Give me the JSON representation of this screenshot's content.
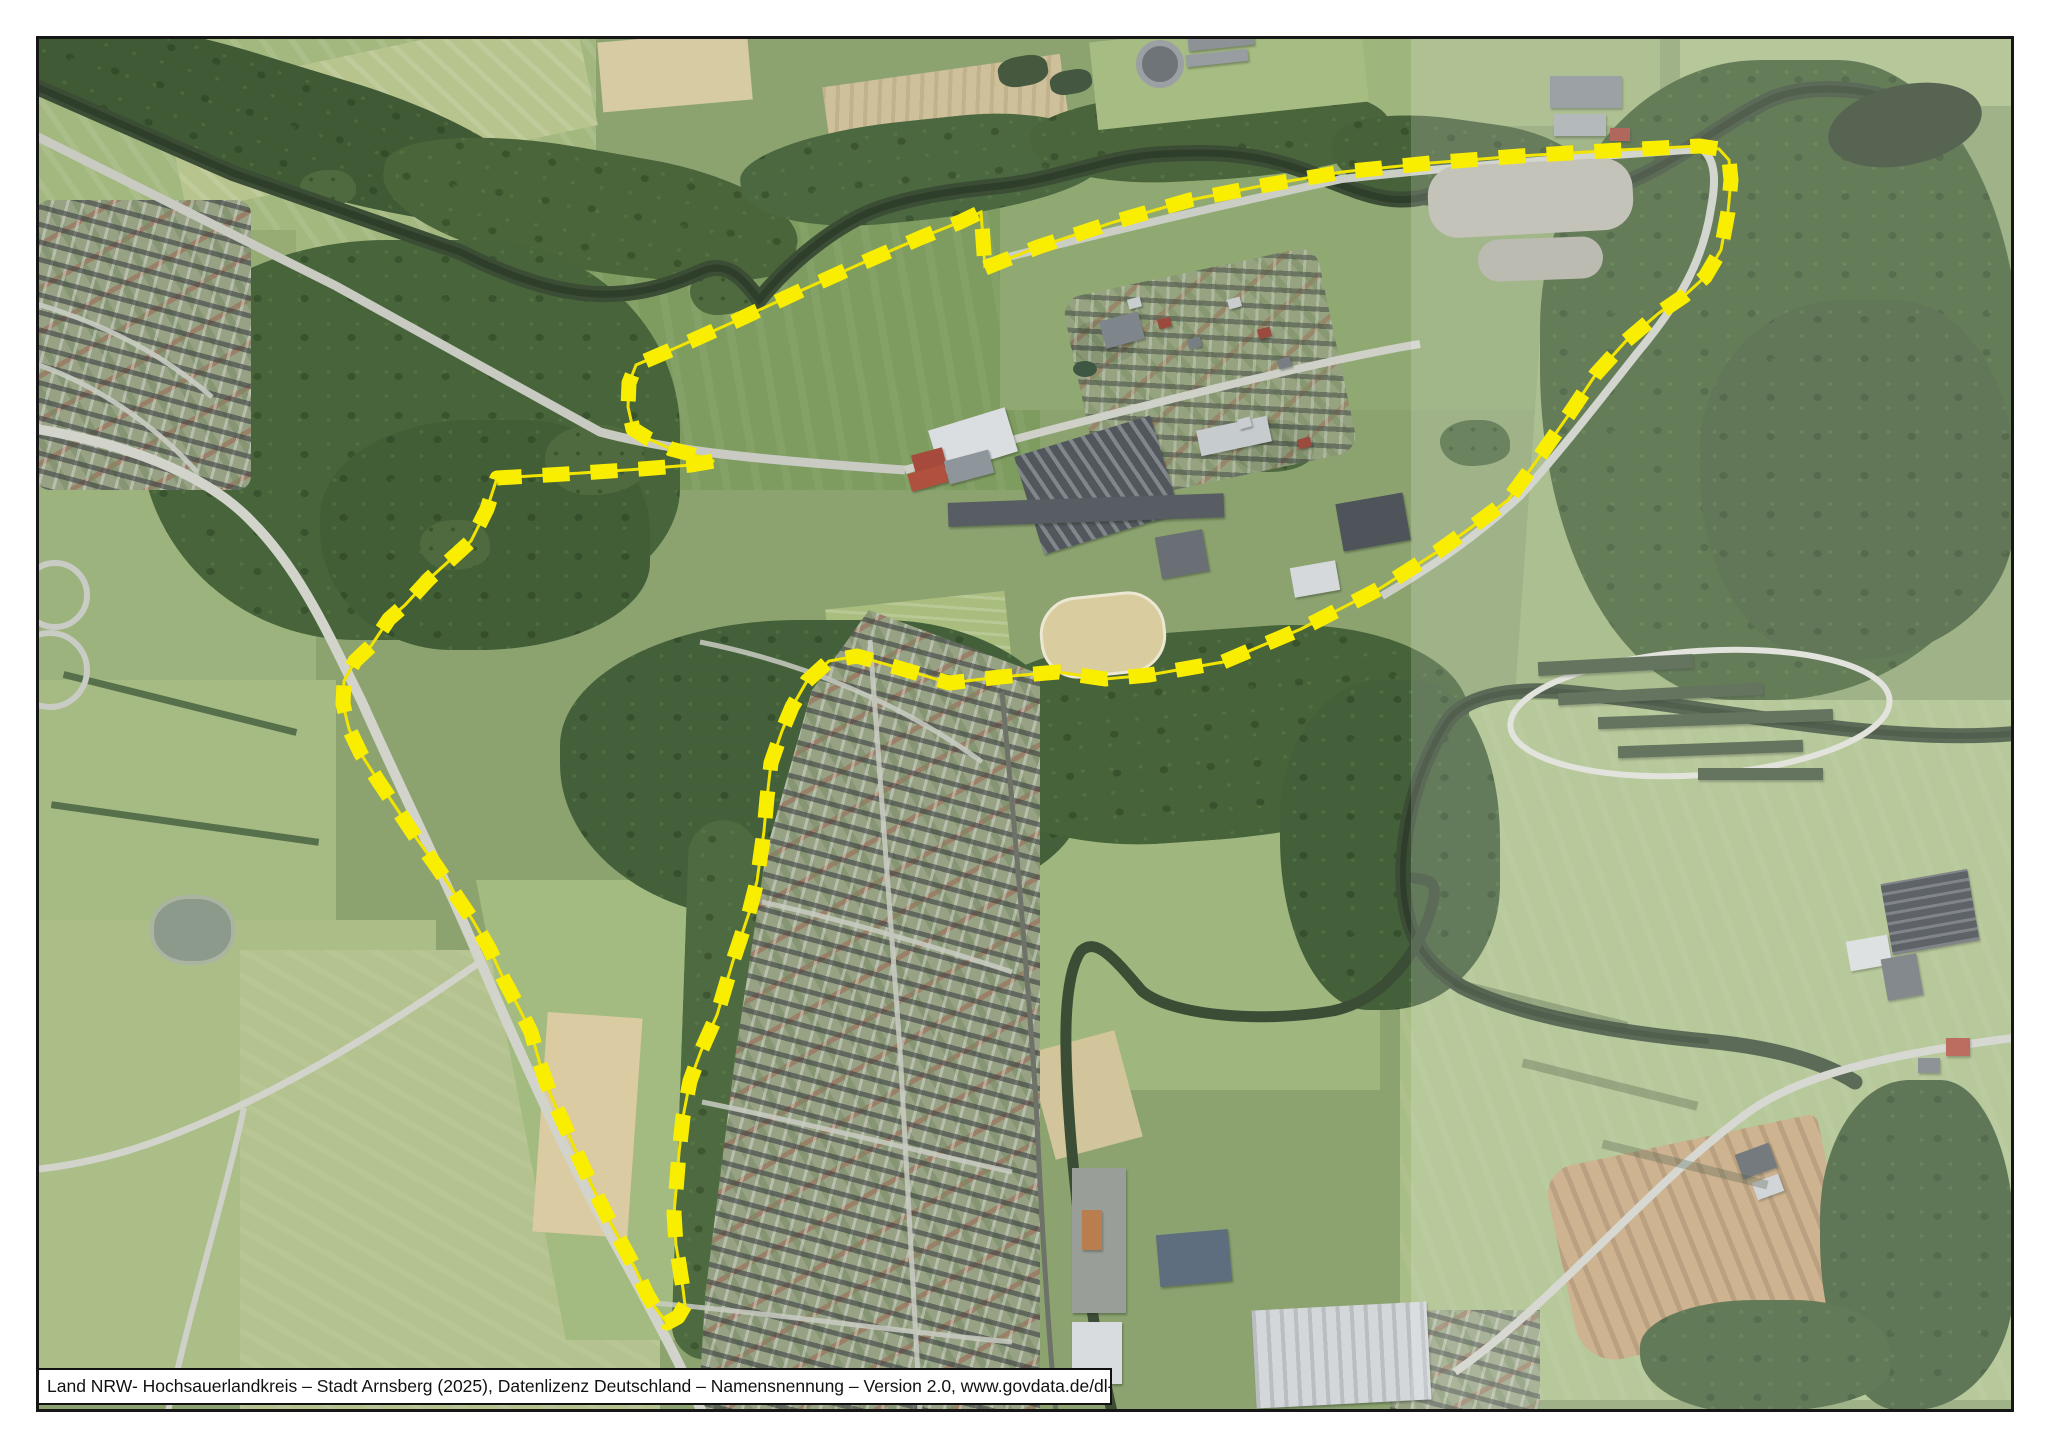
{
  "map": {
    "type": "aerial-orthophoto-sheet",
    "attribution": "Land NRW- Hochsauerlandkreis – Stadt Arnsberg (2025), Datenlizenz Deutschland – Namensnennung – Version 2.0, www.govdata.de/dl-de/by-2-0",
    "frame_color": "#161616",
    "overlay": {
      "exposure_seam_x": 1411,
      "haze_opacity": 0.17
    },
    "boundary": {
      "label": "site-boundary-outline",
      "color": "#FAEE00",
      "underline_color": "#F0E400",
      "stroke_width": 15,
      "dash": [
        27,
        21
      ],
      "points": [
        [
          985,
          268
        ],
        [
          1038,
          247
        ],
        [
          1114,
          222
        ],
        [
          1190,
          200
        ],
        [
          1266,
          185
        ],
        [
          1342,
          172
        ],
        [
          1430,
          163
        ],
        [
          1520,
          156
        ],
        [
          1620,
          150
        ],
        [
          1700,
          146
        ],
        [
          1719,
          149
        ],
        [
          1729,
          160
        ],
        [
          1731,
          180
        ],
        [
          1728,
          212
        ],
        [
          1721,
          250
        ],
        [
          1705,
          277
        ],
        [
          1684,
          296
        ],
        [
          1659,
          313
        ],
        [
          1626,
          341
        ],
        [
          1596,
          374
        ],
        [
          1572,
          410
        ],
        [
          1556,
          433
        ],
        [
          1535,
          463
        ],
        [
          1508,
          500
        ],
        [
          1469,
          529
        ],
        [
          1437,
          552
        ],
        [
          1379,
          589
        ],
        [
          1301,
          629
        ],
        [
          1223,
          662
        ],
        [
          1149,
          675
        ],
        [
          1105,
          679
        ],
        [
          1058,
          672
        ],
        [
          1000,
          677
        ],
        [
          949,
          683
        ],
        [
          899,
          668
        ],
        [
          857,
          656
        ],
        [
          829,
          661
        ],
        [
          807,
          681
        ],
        [
          792,
          707
        ],
        [
          782,
          731
        ],
        [
          771,
          763
        ],
        [
          767,
          798
        ],
        [
          764,
          831
        ],
        [
          757,
          881
        ],
        [
          749,
          913
        ],
        [
          733,
          961
        ],
        [
          717,
          1015
        ],
        [
          701,
          1051
        ],
        [
          690,
          1081
        ],
        [
          683,
          1117
        ],
        [
          679,
          1153
        ],
        [
          676,
          1191
        ],
        [
          674,
          1213
        ],
        [
          676,
          1245
        ],
        [
          679,
          1263
        ],
        [
          683,
          1289
        ],
        [
          685,
          1305
        ],
        [
          678,
          1317
        ],
        [
          667,
          1323
        ],
        [
          654,
          1306
        ],
        [
          647,
          1294
        ],
        [
          636,
          1270
        ],
        [
          621,
          1242
        ],
        [
          609,
          1220
        ],
        [
          595,
          1192
        ],
        [
          579,
          1158
        ],
        [
          564,
          1124
        ],
        [
          551,
          1096
        ],
        [
          540,
          1064
        ],
        [
          531,
          1032
        ],
        [
          519,
          1008
        ],
        [
          504,
          980
        ],
        [
          489,
          948
        ],
        [
          472,
          919
        ],
        [
          457,
          897
        ],
        [
          437,
          867
        ],
        [
          417,
          839
        ],
        [
          397,
          809
        ],
        [
          377,
          779
        ],
        [
          361,
          754
        ],
        [
          349,
          729
        ],
        [
          343,
          704
        ],
        [
          344,
          681
        ],
        [
          355,
          661
        ],
        [
          371,
          646
        ],
        [
          389,
          619
        ],
        [
          405,
          605
        ],
        [
          429,
          579
        ],
        [
          449,
          561
        ],
        [
          471,
          541
        ],
        [
          487,
          509
        ],
        [
          497,
          478
        ],
        [
          531,
          476
        ],
        [
          581,
          473
        ],
        [
          641,
          469
        ],
        [
          691,
          465
        ],
        [
          714,
          461
        ],
        [
          698,
          456
        ],
        [
          671,
          449
        ],
        [
          649,
          439
        ],
        [
          633,
          429
        ],
        [
          628,
          407
        ],
        [
          629,
          383
        ],
        [
          636,
          365
        ],
        [
          680,
          346
        ],
        [
          740,
          319
        ],
        [
          800,
          291
        ],
        [
          860,
          264
        ],
        [
          920,
          238
        ],
        [
          960,
          222
        ],
        [
          981,
          212
        ],
        [
          983,
          239
        ],
        [
          985,
          268
        ]
      ]
    }
  }
}
